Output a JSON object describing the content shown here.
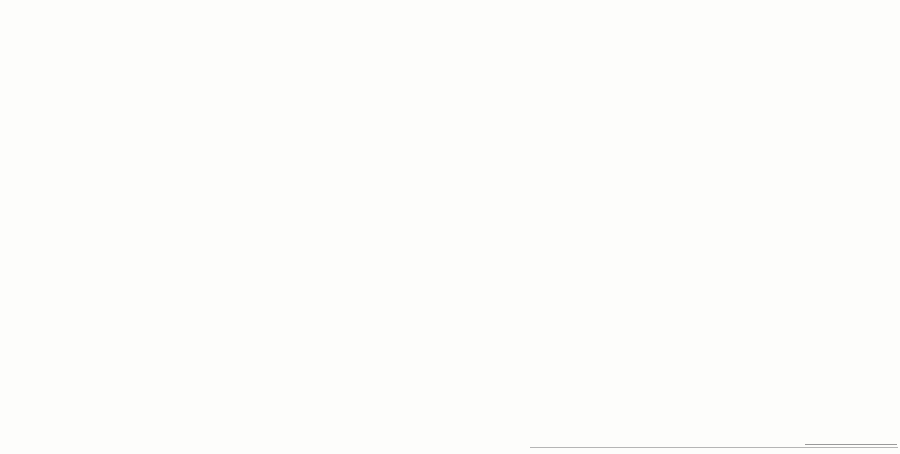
{
  "plan": {
    "scale_label": "M 1:1000",
    "north_label": "N",
    "river_label": "PÄRNU JÕGI",
    "river_sublabel": "(kalda piiranguvöönd)",
    "park_label": "WALDHOFI PARK",
    "legend": {
      "title": "TINGMÄRGID",
      "items": [
        {
          "swatch": "dash",
          "label": "planeeritava ala piir"
        },
        {
          "swatch": "line",
          "label": "olemasolev krundi piir"
        },
        {
          "swatch": "hatch",
          "label": "olemasolev hoonestus, mida ei säilitata / lammutatav hoonestus"
        },
        {
          "swatch": "#ea6a5e",
          "label": "olemasolev korterelamu, 4-5 korrust"
        },
        {
          "swatch": "#62c44e",
          "label": "kavandatav korterelamu, 2-3 korrust"
        },
        {
          "swatch": "#d9a05f",
          "label": "kavandatav äri- ja büroohoone, 3-4 korrust"
        },
        {
          "swatch": "#c8ea2e",
          "label": "kavandatav üksikelamu, 2 korrust"
        },
        {
          "swatch": "#f3bd88",
          "label": "olemasolev hoone, rekonstrueeritav 3-4 korrust"
        },
        {
          "swatch": "#e8872e",
          "label": "kavandatav korterelamu, 3-4 korrust"
        },
        {
          "swatch": "#f3c9a2",
          "label": "äripinnad 1. korrusel"
        },
        {
          "swatch": "#fae4cf",
          "label": "reserveeritav ala perspektiivseks hoonestuseks"
        },
        {
          "swatch": "#a4a673",
          "label": "kavandatav parkimismaja, 1-2 korrust"
        },
        {
          "swatch": "#bdbdbd",
          "label": "sõidutee, asfaltkate"
        },
        {
          "swatch": "#ee3333",
          "label": "ühiskondlik hoone"
        },
        {
          "swatch": "#d9d9d9",
          "label": "kergliiklustee, kõnnitee"
        },
        {
          "swatch": "#f3ee3e",
          "label": "laste mänguväljak"
        },
        {
          "swatch": "dots",
          "label": "haljasala, muru"
        },
        {
          "swatch": "icon-trees",
          "label": "kõrghaljastus, puud"
        },
        {
          "swatch": "icon-lamp",
          "label": "välisvalgustus"
        },
        {
          "swatch": "icon-bin",
          "label": "prügikonteinerite plats"
        },
        {
          "swatch": "icon-map",
          "label": "asendiskeem M 1:5000"
        }
      ]
    },
    "notes": {
      "title": "PLANEERITAVA MAA-ALA ANDMED JA NÄITAJAD",
      "lines": [
        "1. Planeeritava ala suurus 10,2 ha, sellest elamumaa 6,4 ha ja üldmaa 2,0 ha (≈ 17,6%)",
        "2. Kavandatud hoonestusala kokku 24 360 m²",
        "korterelamud 14 250 m², üksikelamud 4 110 m², ärihooned 5 990 m² — ≈ 28,4%",
        "suurim lubatud korruselisus 5 korrust, suletud brutopind kokku 58 400 m²",
        "3. Täisehituse protsent — ≈ 22,97%",
        "4. Haljastuse osakaal planeeritavast alast min 30,87%, sh kõrghaljastus 12,4%",
        "parkimiskohti kokku 412 tk, neist maa-alustes parklates 186 tk ≈ 33,0%",
        "sõiduteede ja platside pindala 1,8 ha ≈ 20,4%, kergliiklusteed 0,6 ha",
        "5. Tehnovõrgud: veevarustus, kanalisatsioon, elekter ja side — liitumine",
        "olemasolevate trassidega; sademevesi juhitakse Pärnu jõkke ≈ 28,0%",
        "6. Keskkonnatingimused: müra normtase II kat., radooniohutu lahendus",
        "ehitusprojektide koostamisel lähtuda detailplaneeringu põhijoonisest — ≈ 23,5%"
      ]
    }
  },
  "colors": {
    "accent_orange": "#e8752a",
    "building_dark": "#3a3a3e",
    "sky_blue": "#2f96d5",
    "grass_green": "#63b832",
    "map_red": "#ea6a5e",
    "map_orange": "#f09a48",
    "map_green": "#62c44e",
    "map_chartreuse": "#c8ea2e",
    "map_khaki": "#ded9a2",
    "map_olive": "#a4a673",
    "river_blue": "#d6e7ee",
    "diamond_red": "#e80e0e",
    "water_blue": "#7787a8"
  }
}
